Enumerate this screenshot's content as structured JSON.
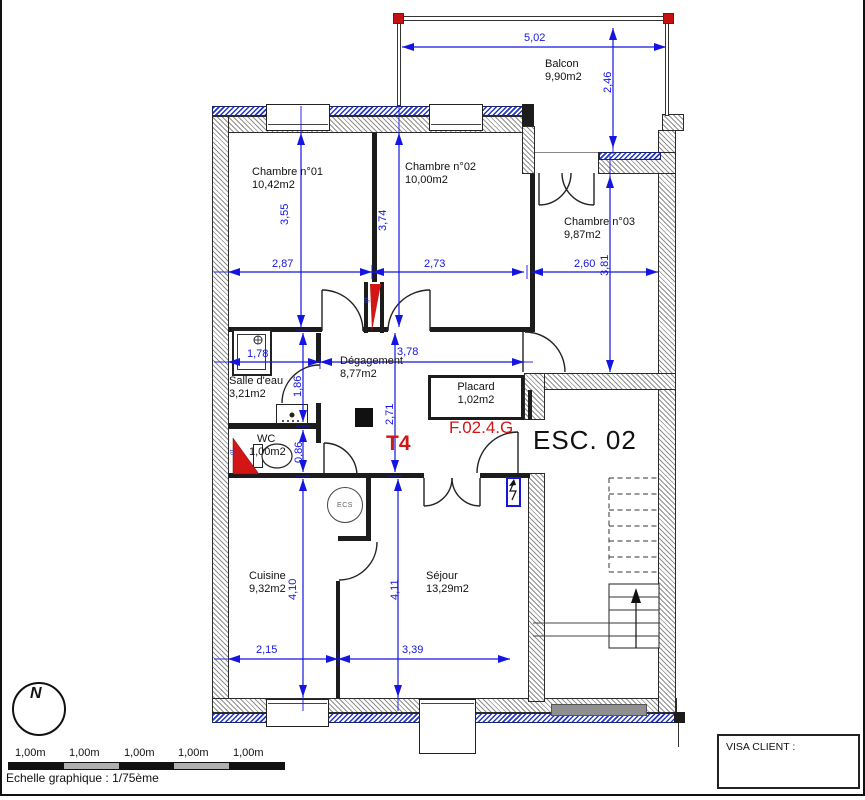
{
  "labels": {
    "unit_type": "T4",
    "unit_ref": "F.02.4.G",
    "stair": "ESC. 02",
    "water_heater": "ECS",
    "duct": "gt",
    "north": "N"
  },
  "rooms": {
    "ch01": {
      "name": "Chambre n°01",
      "area": "10,42m2"
    },
    "ch02": {
      "name": "Chambre n°02",
      "area": "10,00m2"
    },
    "ch03": {
      "name": "Chambre n°03",
      "area": "9,87m2"
    },
    "balcon": {
      "name": "Balcon",
      "area": "9,90m2"
    },
    "sde": {
      "name": "Salle d'eau",
      "area": "3,21m2"
    },
    "wc": {
      "name": "WC",
      "area": "1,00m2"
    },
    "degagement": {
      "name": "Dégagement",
      "area": "8,77m2"
    },
    "placard": {
      "name": "Placard",
      "area": "1,02m2"
    },
    "cuisine": {
      "name": "Cuisine",
      "area": "9,32m2"
    },
    "sejour": {
      "name": "Séjour",
      "area": "13,29m2"
    }
  },
  "dims": {
    "balcony_width": "5,02",
    "balcony_depth": "2,46",
    "ch01_w": "2,87",
    "ch02_w": "2,73",
    "ch03_w": "2,60",
    "ch01_h": "3,55",
    "ch02_h": "3,74",
    "ch03_h": "3,81",
    "sde_w": "1,78",
    "deg_w": "3,78",
    "sde_h": "1,86",
    "deg_h": "2,71",
    "wc_h": "0,86",
    "cuisine_w": "2,15",
    "sejour_w": "3,39",
    "cuisine_h": "4,10",
    "sejour_h": "4,11"
  },
  "scale_bar": {
    "labels": [
      "1,00m",
      "1,00m",
      "1,00m",
      "1,00m",
      "1,00m"
    ],
    "caption": "Echelle graphique : 1/75ème"
  },
  "visa": {
    "label": "VISA CLIENT :"
  }
}
